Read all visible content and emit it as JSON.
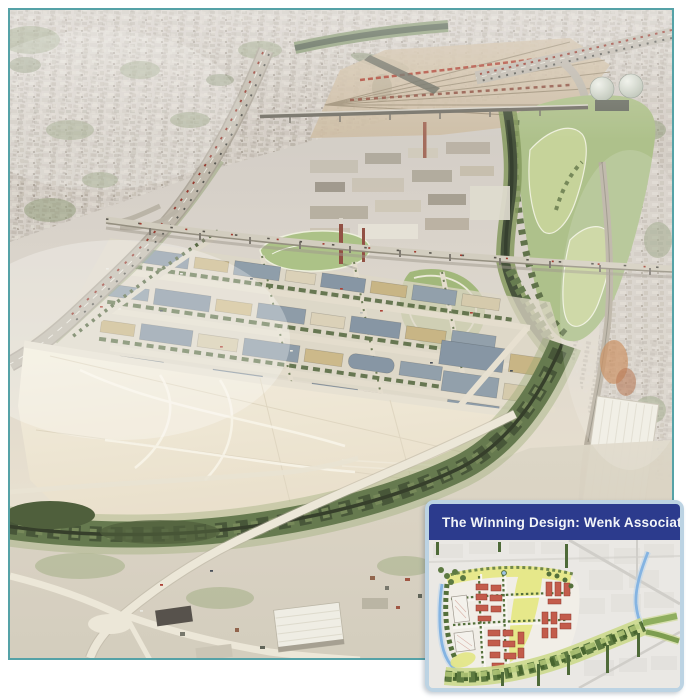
{
  "inset": {
    "title": "The Winning Design: Wenk Associates"
  },
  "colors": {
    "page_bg": "#ffffff",
    "photo_border": "#55a2a7",
    "inset_border": "#bcd3e3",
    "inset_header_bg": "#2c3b8d",
    "inset_header_text": "#f2f4f8",
    "plan_building_red": "#c35c4c",
    "plan_open_space_yellow": "#e6e88a",
    "plan_park_green": "#5d7a40",
    "plan_river_blue": "#85b4e2",
    "aerial_river_dark_green": "#39462f",
    "aerial_tree_band": "#5b7044",
    "aerial_vacant_lot_cream": "#f0e9da",
    "aerial_roof_slate": "#7e8fa0",
    "aerial_roof_tan": "#c5b07e"
  }
}
